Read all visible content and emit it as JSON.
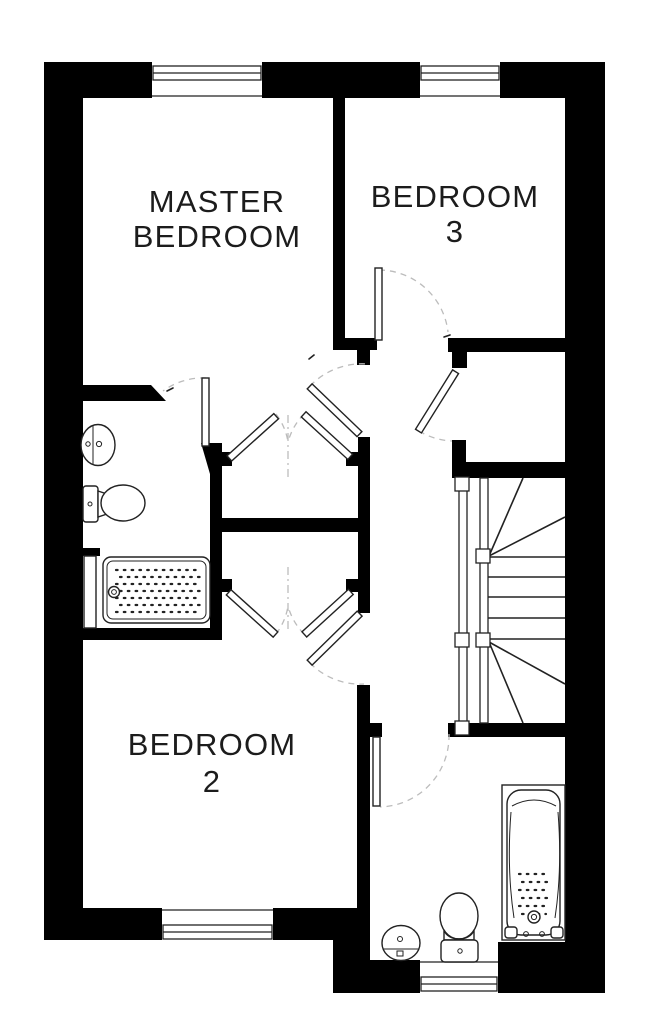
{
  "floor_plan": {
    "rooms": {
      "master_bedroom": {
        "line1": "MASTER",
        "line2": "BEDROOM"
      },
      "bedroom_3": {
        "line1": "BEDROOM",
        "line2": "3"
      },
      "bedroom_2": {
        "line1": "BEDROOM",
        "line2": "2"
      }
    },
    "fixtures": [
      "sink",
      "toilet",
      "shower-tray",
      "shower-screen",
      "bathtub",
      "staircase"
    ],
    "window_count": 4,
    "colors": {
      "wall": "#000000",
      "line": "#222222",
      "door_arc": "#bcbcbc",
      "text": "#1c1c1c",
      "background": "#ffffff"
    }
  }
}
